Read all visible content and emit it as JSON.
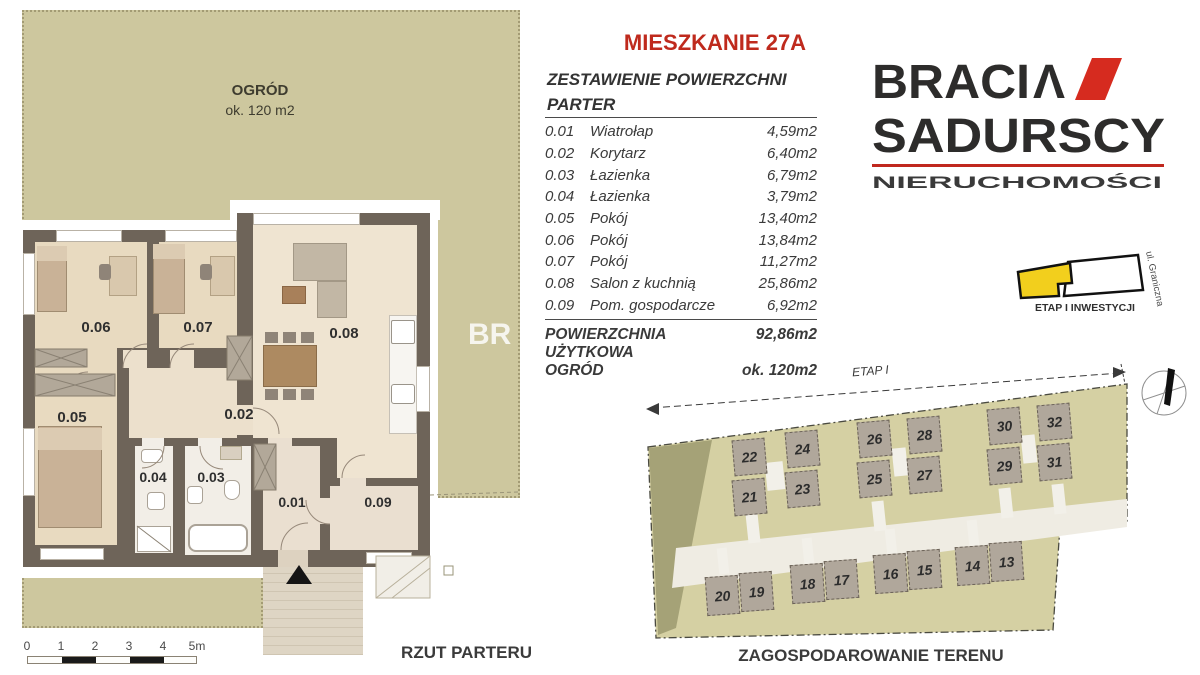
{
  "title": "MIESZKANIE 27A",
  "watermark": "BR",
  "area_table": {
    "header_line1": "ZESTAWIENIE POWIERZCHNI",
    "header_line2": "PARTER",
    "rows": [
      {
        "no": "0.01",
        "name": "Wiatrołap",
        "area": "4,59m2"
      },
      {
        "no": "0.02",
        "name": "Korytarz",
        "area": "6,40m2"
      },
      {
        "no": "0.03",
        "name": "Łazienka",
        "area": "6,79m2"
      },
      {
        "no": "0.04",
        "name": "Łazienka",
        "area": "3,79m2"
      },
      {
        "no": "0.05",
        "name": "Pokój",
        "area": "13,40m2"
      },
      {
        "no": "0.06",
        "name": "Pokój",
        "area": "13,84m2"
      },
      {
        "no": "0.07",
        "name": "Pokój",
        "area": "11,27m2"
      },
      {
        "no": "0.08",
        "name": "Salon z kuchnią",
        "area": "25,86m2"
      },
      {
        "no": "0.09",
        "name": "Pom. gospodarcze",
        "area": "6,92m2"
      }
    ],
    "total_label": "POWIERZCHNIA UŻYTKOWA",
    "total_value": "92,86m2",
    "garden_label": "OGRÓD",
    "garden_value": "ok. 120m2"
  },
  "logo": {
    "word1": "BRACI",
    "word1_mark": "Λ",
    "word2": "SADURSCY",
    "tagline": "NIERUCHOMOŚCI"
  },
  "inset_map": {
    "street": "ul. Graniczna",
    "caption": "ETAP I INWESTYCJI"
  },
  "floor_plan": {
    "garden_title": "OGRÓD",
    "garden_area": "ok. 120 m2",
    "caption": "RZUT PARTERU",
    "room_labels": {
      "r06": "0.06",
      "r07": "0.07",
      "r08": "0.08",
      "r05": "0.05",
      "r02": "0.02",
      "r04": "0.04",
      "r03": "0.03",
      "r01": "0.01",
      "r09": "0.09"
    },
    "scale_ticks": [
      "0",
      "1",
      "2",
      "3",
      "4",
      "5m"
    ]
  },
  "site_plan": {
    "caption": "ZAGOSPODAROWANIE TERENU",
    "dimension_label": "ETAP I",
    "units_top": [
      "22",
      "21",
      "24",
      "23",
      "26",
      "25",
      "28",
      "27",
      "30",
      "29",
      "32",
      "31"
    ],
    "units_bottom": [
      "20",
      "19",
      "18",
      "17",
      "16",
      "15",
      "14",
      "13"
    ]
  },
  "colors": {
    "accent_red": "#bf2a1d",
    "garden_green": "#cdc79e",
    "wall_dark": "#6e6459",
    "highlight_yellow": "#f2cf1d"
  }
}
